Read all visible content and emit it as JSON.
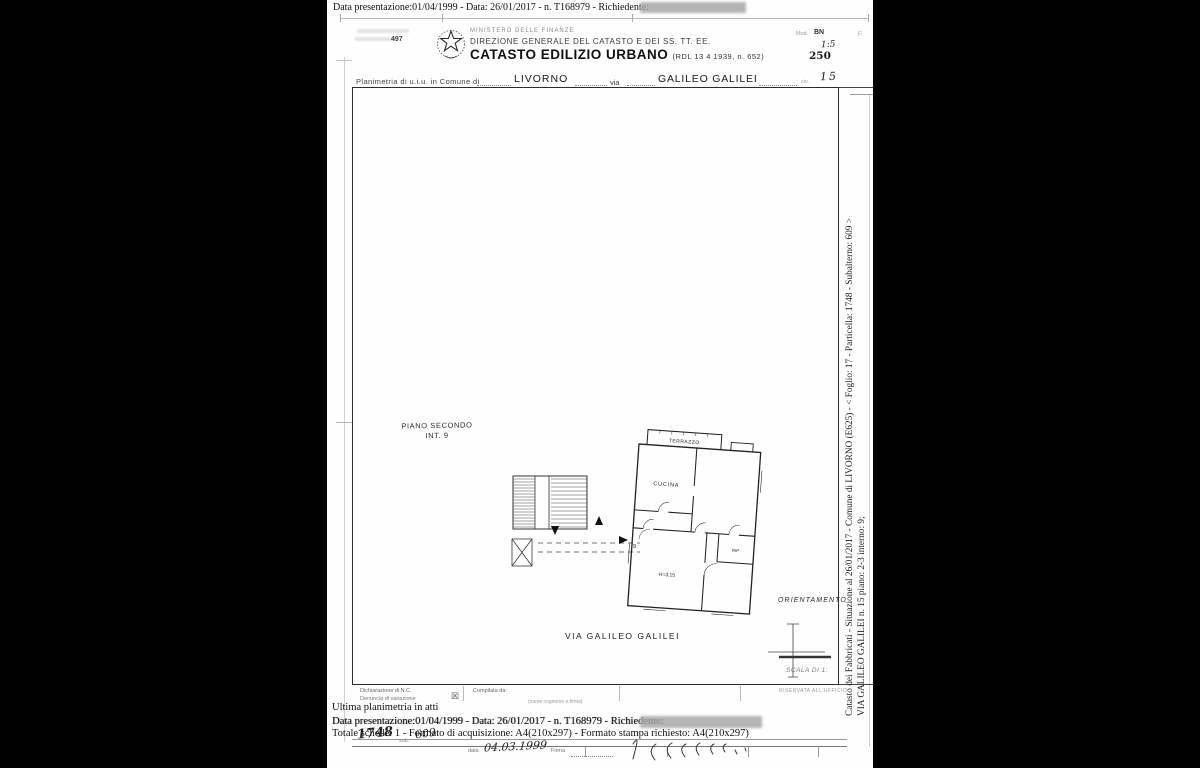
{
  "overlay": {
    "top_line": "Data presentazione:01/04/1999 - Data: 26/01/2017 - n. T168979 - Richiedente:"
  },
  "header": {
    "form_number": "497",
    "ministry": "MINISTERO DELLE FINANZE",
    "direction": "DIREZIONE GENERALE DEL CATASTO E DEI SS. TT. EE.",
    "title": "CATASTO EDILIZIO URBANO",
    "title_ref": "(RDL 13 4 1939, n. 652)",
    "mod_label": "Mod.",
    "mod_value": "BN",
    "mod_f": "F.",
    "scale_hand_top": "1:5",
    "scale_hand": "250",
    "line_label": "Planimetria di u.i.u. in Comune di",
    "comune": "LIVORNO",
    "via_label": "via",
    "via_value": "GALILEO GALILEI",
    "civ_label": "civ.",
    "civ_value": "15"
  },
  "plan": {
    "floor1": "PIANO SECONDO",
    "floor2": "INT. 9",
    "room_terrazzo": "TERRAZZO",
    "room_cucina": "CUCINA",
    "room_rip": "RIP.",
    "room_height": "H=3.15",
    "door_number": "9",
    "street_label": "VIA GALILEO GALILEI",
    "orientation_label": "ORIENTAMENTO",
    "scale_label": "SCALA DI 1:"
  },
  "margin": {
    "line1": "Catasto dei Fabbricati - Situazione al 26/01/2017 - Comune di LIVORNO (E625) - < Foglio: 17 - Particella: 1748 - Subalterno: 609 >",
    "line2": "VIA GALILEO GALILEI n. 15 piano: 2-3 interno: 9;"
  },
  "footer": {
    "decl1": "Dichiarazione di N.C.",
    "decl2": "Denuncia di variazione",
    "checkbox": "☒",
    "compiled_label": "Compilata da:",
    "compiled_sub": "(nome cognome e firma)",
    "office_label": "RISERVATA ALL'UFFICIO",
    "ultima": "Ultima planimetria in atti",
    "data_line": "Data presentazione:01/04/1999 - Data: 26/01/2017 - n. T168979 - Richiedente:",
    "totale_line": "Totale schede: 1 - Formato di acquisizione: A4(210x297) - Formato stampa richiesto: A4(210x297)",
    "particella_hand": "1748",
    "sub_label": "sub.",
    "sub_hand": "609",
    "data_label": "data",
    "data_hand": "04.03.1999",
    "firma_label": "Firma"
  }
}
